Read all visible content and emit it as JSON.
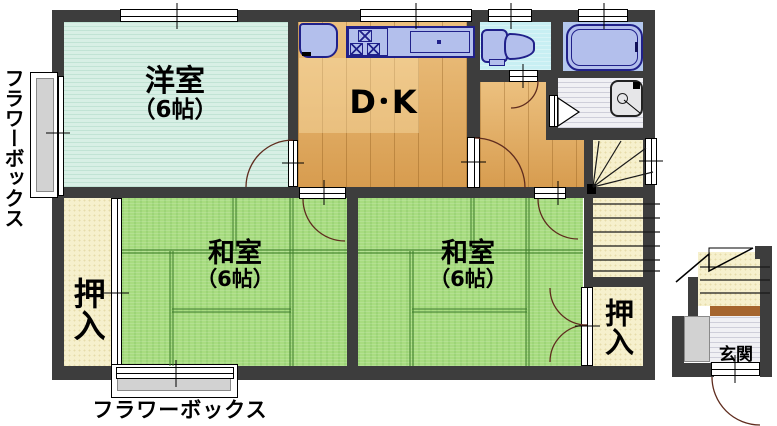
{
  "plan_title": "apartment-floor-plan",
  "rooms": {
    "western": {
      "name": "洋室",
      "size": "（6帖）"
    },
    "dk": {
      "name": "D･K"
    },
    "japanese1": {
      "name": "和室",
      "size": "（6帖）"
    },
    "japanese2": {
      "name": "和室",
      "size": "（6帖）"
    },
    "closet1": {
      "name": "押入"
    },
    "closet2": {
      "name": "押入"
    },
    "entrance": {
      "name": "玄関"
    }
  },
  "annotations": {
    "flower_box_left": "フラワーボックス",
    "flower_box_bottom": "フラワーボックス"
  },
  "colors": {
    "wall": "#3d3d3d",
    "tatami_green": "#a8dc80",
    "western_floor": "#d8efe5",
    "wood_floor": "#e2a758",
    "closet_cream": "#f6f0cd",
    "fixture_blue": "#b3bfec",
    "fixture_outline": "#20208a",
    "toilet_floor": "#c8eff3",
    "bath_floor": "#b4c8ee",
    "step_brown": "#a5652e",
    "flower_box_gray": "#d2d2d2"
  }
}
